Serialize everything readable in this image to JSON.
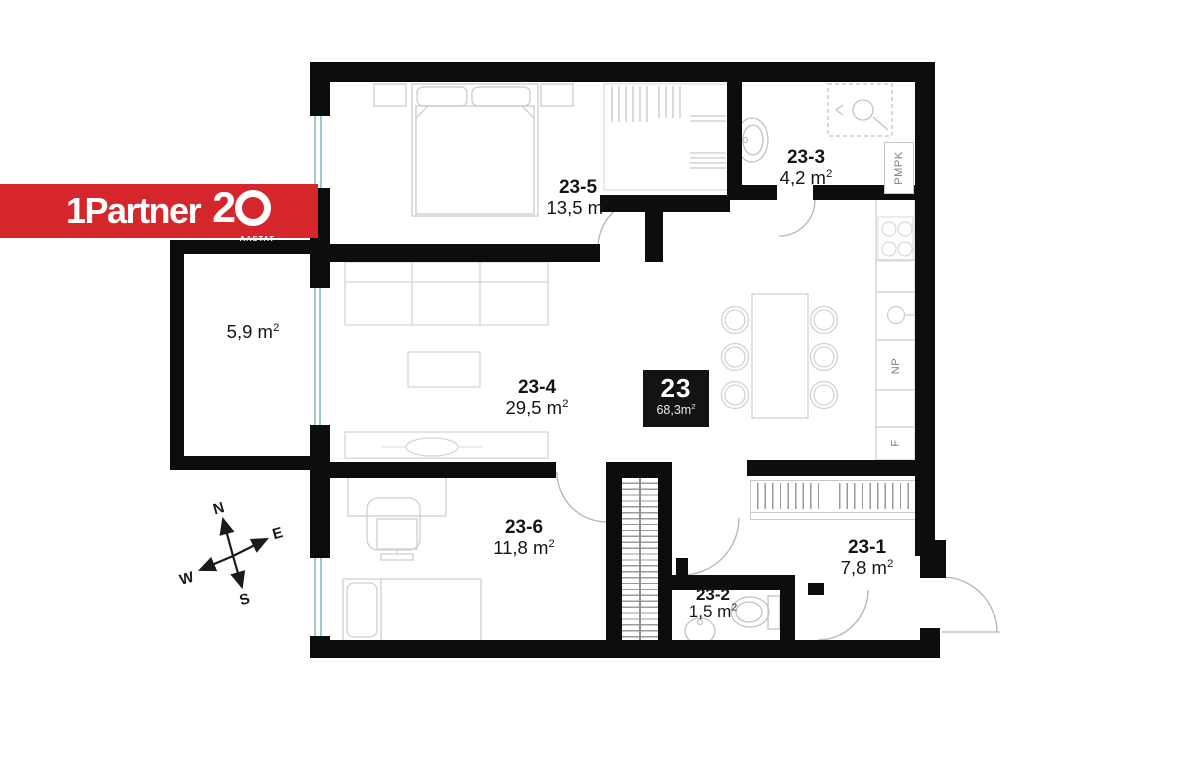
{
  "logo": {
    "brand": "1Partner",
    "anniversary_digit": "2",
    "anniversary_suffix": "AASTAT"
  },
  "unit": {
    "number": "23",
    "total_area": "68,3m²"
  },
  "rooms": {
    "r235": {
      "id": "23-5",
      "area": "13,5 m²"
    },
    "r233": {
      "id": "23-3",
      "area": "4,2 m²"
    },
    "r234": {
      "id": "23-4",
      "area": "29,5 m²"
    },
    "r236": {
      "id": "23-6",
      "area": "11,8 m²"
    },
    "r232": {
      "id": "23-2",
      "area": "1,5 m²"
    },
    "r231": {
      "id": "23-1",
      "area": "7,8 m²"
    },
    "balcony": {
      "area": "5,9 m²"
    }
  },
  "fixtures": {
    "pmpk": "PMPK",
    "np": "NP",
    "f": "F"
  },
  "compass": {
    "n": "N",
    "e": "E",
    "s": "S",
    "w": "W"
  },
  "colors": {
    "wall": "#0d0d0d",
    "accent_red": "#d5262b",
    "window": "#9ec9cf"
  }
}
